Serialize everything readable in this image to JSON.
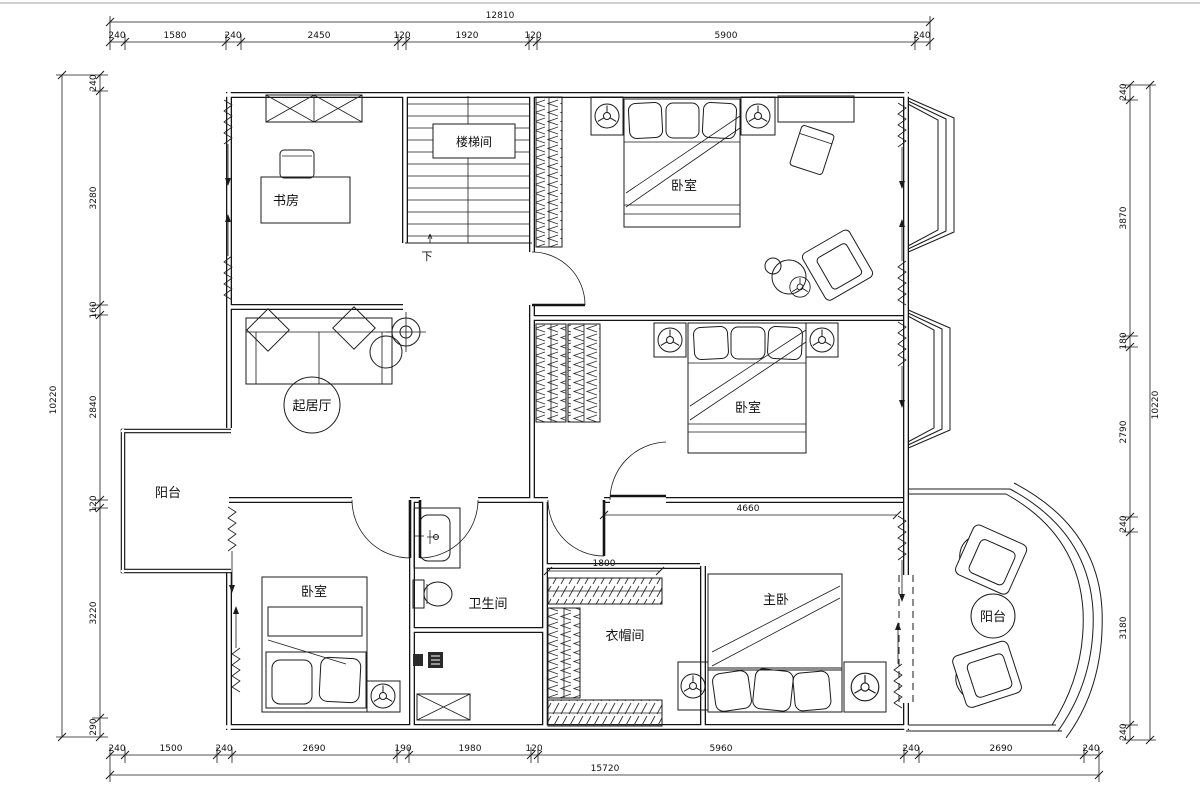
{
  "drawing": {
    "background": "#ffffff",
    "line_color": "#1b1b1b"
  },
  "rooms": {
    "study": "书房",
    "stairwell": "楼梯间",
    "stairs_down": "下",
    "bedroom_top": "卧室",
    "bedroom_mid": "卧室",
    "bedroom_small": "卧室",
    "living_hall": "起居厅",
    "balcony_left": "阳台",
    "balcony_right": "阳台",
    "bathroom": "卫生间",
    "cloakroom": "衣帽间",
    "master_bedroom": "主卧"
  },
  "dimensions": {
    "top": {
      "overall": "12810",
      "segments": [
        "240",
        "1580",
        "240",
        "2450",
        "120",
        "1920",
        "120",
        "5900",
        "240"
      ]
    },
    "bottom": {
      "overall": "15720",
      "segments": [
        "240",
        "1500",
        "240",
        "2690",
        "190",
        "1980",
        "120",
        "5960",
        "240",
        "2690",
        "240"
      ]
    },
    "left": {
      "overall": "10220",
      "segments": [
        "240",
        "3280",
        "160",
        "2840",
        "120",
        "3220",
        "290"
      ]
    },
    "right": {
      "overall": "10220",
      "segments": [
        "240",
        "3870",
        "180",
        "2790",
        "240",
        "3180",
        "240"
      ]
    },
    "interior": {
      "cloakroom_width": "1800",
      "master_span": "4660"
    }
  }
}
